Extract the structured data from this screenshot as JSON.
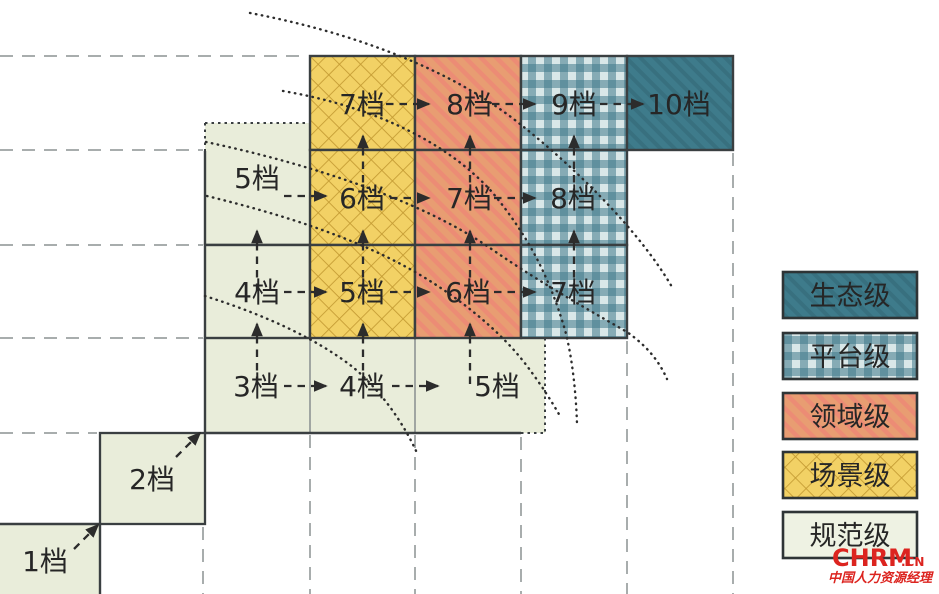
{
  "figure": {
    "description": "Capability grade staircase matrix: grades 1档-10档 across maturity levels",
    "grade_unit": "档"
  },
  "grid": {
    "rows": [
      {
        "cells": [
          {
            "label": "7档",
            "category": "场景级"
          },
          {
            "label": "8档",
            "category": "领域级"
          },
          {
            "label": "9档",
            "category": "平台级"
          },
          {
            "label": "10档",
            "category": "生态级"
          }
        ]
      },
      {
        "cells": [
          {
            "label": "5档",
            "category": "规范级"
          },
          {
            "label": "6档",
            "category": "场景级"
          },
          {
            "label": "7档",
            "category": "领域级"
          },
          {
            "label": "8档",
            "category": "平台级"
          }
        ]
      },
      {
        "cells": [
          {
            "label": "4档",
            "category": "规范级"
          },
          {
            "label": "5档",
            "category": "场景级"
          },
          {
            "label": "6档",
            "category": "领域级"
          },
          {
            "label": "7档",
            "category": "平台级"
          }
        ]
      },
      {
        "cells": [
          {
            "label": "3档",
            "category": "规范级"
          },
          {
            "label": "4档",
            "category": "规范级"
          },
          {
            "label": "5档",
            "category": "规范级"
          }
        ]
      }
    ],
    "steps": [
      {
        "label": "2档",
        "category": "规范级"
      },
      {
        "label": "1档",
        "category": "规范级"
      }
    ]
  },
  "legend": {
    "items": [
      {
        "label": "生态级",
        "color": "#3e7b8b",
        "pattern": "dark-solid-hatch"
      },
      {
        "label": "平台级",
        "color": "#8fb3ba",
        "pattern": "gingham-check"
      },
      {
        "label": "领域级",
        "color": "#e89d72",
        "pattern": "diagonal-stripes"
      },
      {
        "label": "场景级",
        "color": "#f2d165",
        "pattern": "diamond-lattice"
      },
      {
        "label": "规范级",
        "color": "#e9edda",
        "pattern": "plain"
      }
    ]
  },
  "watermark": {
    "brand": "CHRM",
    "domain": ".CN",
    "subtitle": "中国人力资源经理",
    "color": "#dc241f"
  },
  "colors": {
    "yellow_base": "#f2d165",
    "yellow_lattice": "#c49b33",
    "orange_base": "#e89d72",
    "orange_stripe": "#ef8276",
    "teal_light": "#d9e7e8",
    "teal_mid": "#42798a",
    "teal_dark": "#3e7b8b",
    "green_base": "#e9edda",
    "legend_green": "#eef2e3",
    "border_dark": "#3a3f41",
    "border_thin": "#8f9494",
    "grid_dash": "#a8adad",
    "arrow_ink": "#2c2c2c",
    "text_ink": "#262626"
  }
}
